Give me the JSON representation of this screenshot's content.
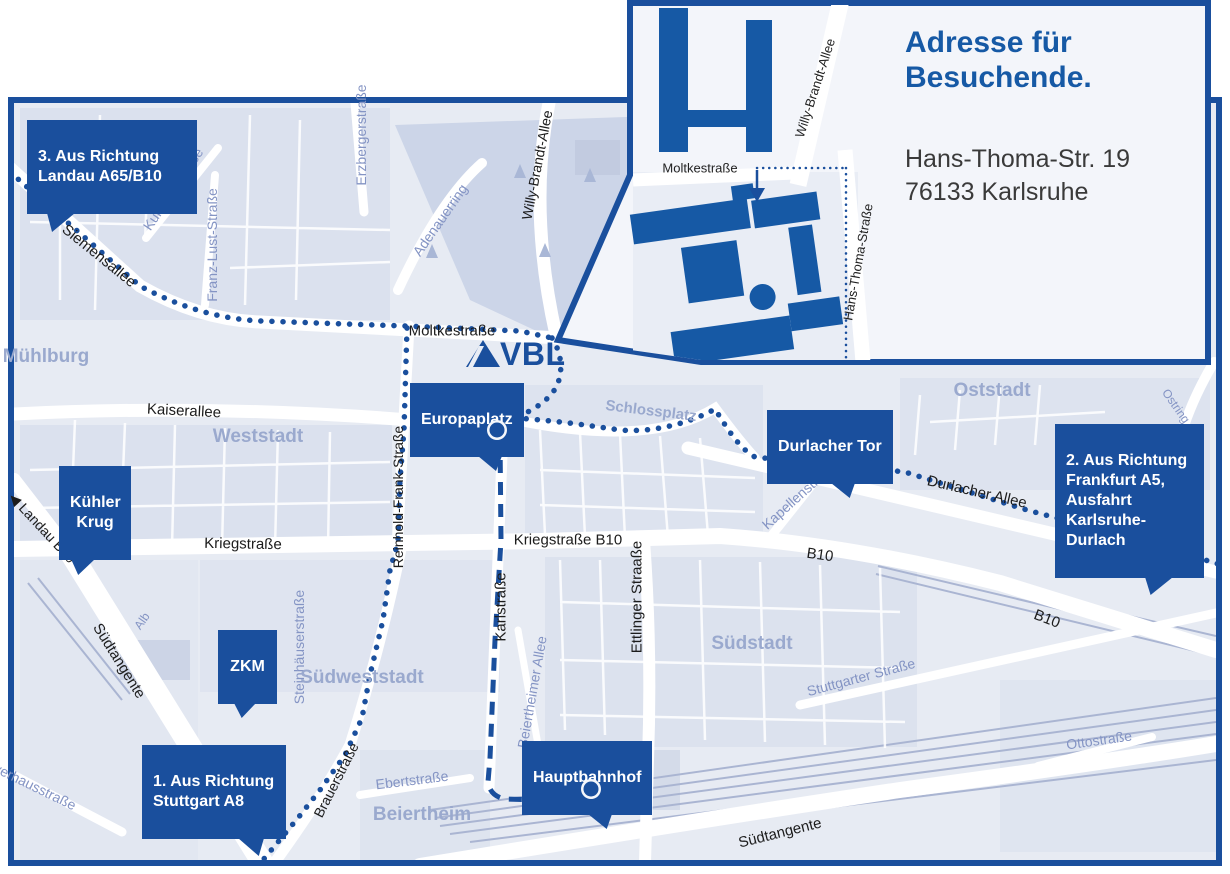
{
  "colors": {
    "primary_blue": "#1a4f9d",
    "heading_blue": "#1659a5",
    "map_bg": "#e7ebf3",
    "district_label": "#9aa9ce",
    "street_label_blue": "#8494c4",
    "street_label_black": "#1c1c1c"
  },
  "logo": {
    "text": "VBL"
  },
  "inset": {
    "title": "Adresse für\nBesuchende.",
    "address_line1": "Hans-Thoma-Str. 19",
    "address_line2": "76133 Karlsruhe",
    "street_moltkestrasse": "Moltkestraße",
    "street_willy_brandt": "Willy-Brandt-Allee",
    "street_hans_thoma": "Hans-Thoma-Straße"
  },
  "callouts": {
    "landau": "3. Aus Richtung\nLandau A65/B10",
    "kuehler_krug": "Kühler\nKrug",
    "zkm": "ZKM",
    "stuttgart": "1. Aus Richtung\nStuttgart A8",
    "europaplatz": "Europaplatz",
    "durlacher_tor": "Durlacher Tor",
    "frankfurt": "2. Aus Richtung\nFrankfurt A5,\nAusfahrt\nKarlsruhe-Durlach",
    "hauptbahnhof": "Hauptbahnhof"
  },
  "districts": {
    "muehlburg": "Mühlburg",
    "weststadt": "Weststadt",
    "oststadt": "Oststadt",
    "suedstadt": "Südstadt",
    "suedweststadt": "Südweststadt",
    "beiertheim": "Beiertheim",
    "schlossplatz": "Schlossplatz"
  },
  "streets": {
    "siemensallee": "Siemensallee",
    "kussmaulstrasse": "Kußmaulstraße",
    "franz_lust": "Franz-Lust-Straße",
    "erzbergerstrasse": "Erzbergerstraße",
    "adenauerring": "Adenauerring",
    "willy_brandt": "Willy-Brandt-Allee",
    "moltkestrasse": "Moltkestraße",
    "kaiserallee": "Kaiserallee",
    "kriegstrasse": "Kriegstraße",
    "kriegstrasse_b10": "Kriegstraße B10",
    "reinhold_frank": "Reinhold-Frank-Straße",
    "karlstrasse": "Karlstraße",
    "ettlinger": "Ettlinger Straaße",
    "beiertheimer_allee": "Beiertheimer Allee",
    "steinhaeuserstrasse": "Steinhäuserstraße",
    "brauerstrasse": "Brauerstraße",
    "ebertstrasse": "Ebertstraße",
    "durlacher_allee": "Durlacher Allee",
    "kapellenstrasse": "Kapellenstraße",
    "ostring": "Ostring",
    "b10": "B10",
    "stuttgarter": "Stuttgarter Straße",
    "ottostrasse": "Ottostraße",
    "suedtangente": "Südtangente",
    "landau_b10": "◀ Landau B10",
    "pulverhausstrasse": "Pulverhausstraße",
    "alb": "Alb"
  }
}
